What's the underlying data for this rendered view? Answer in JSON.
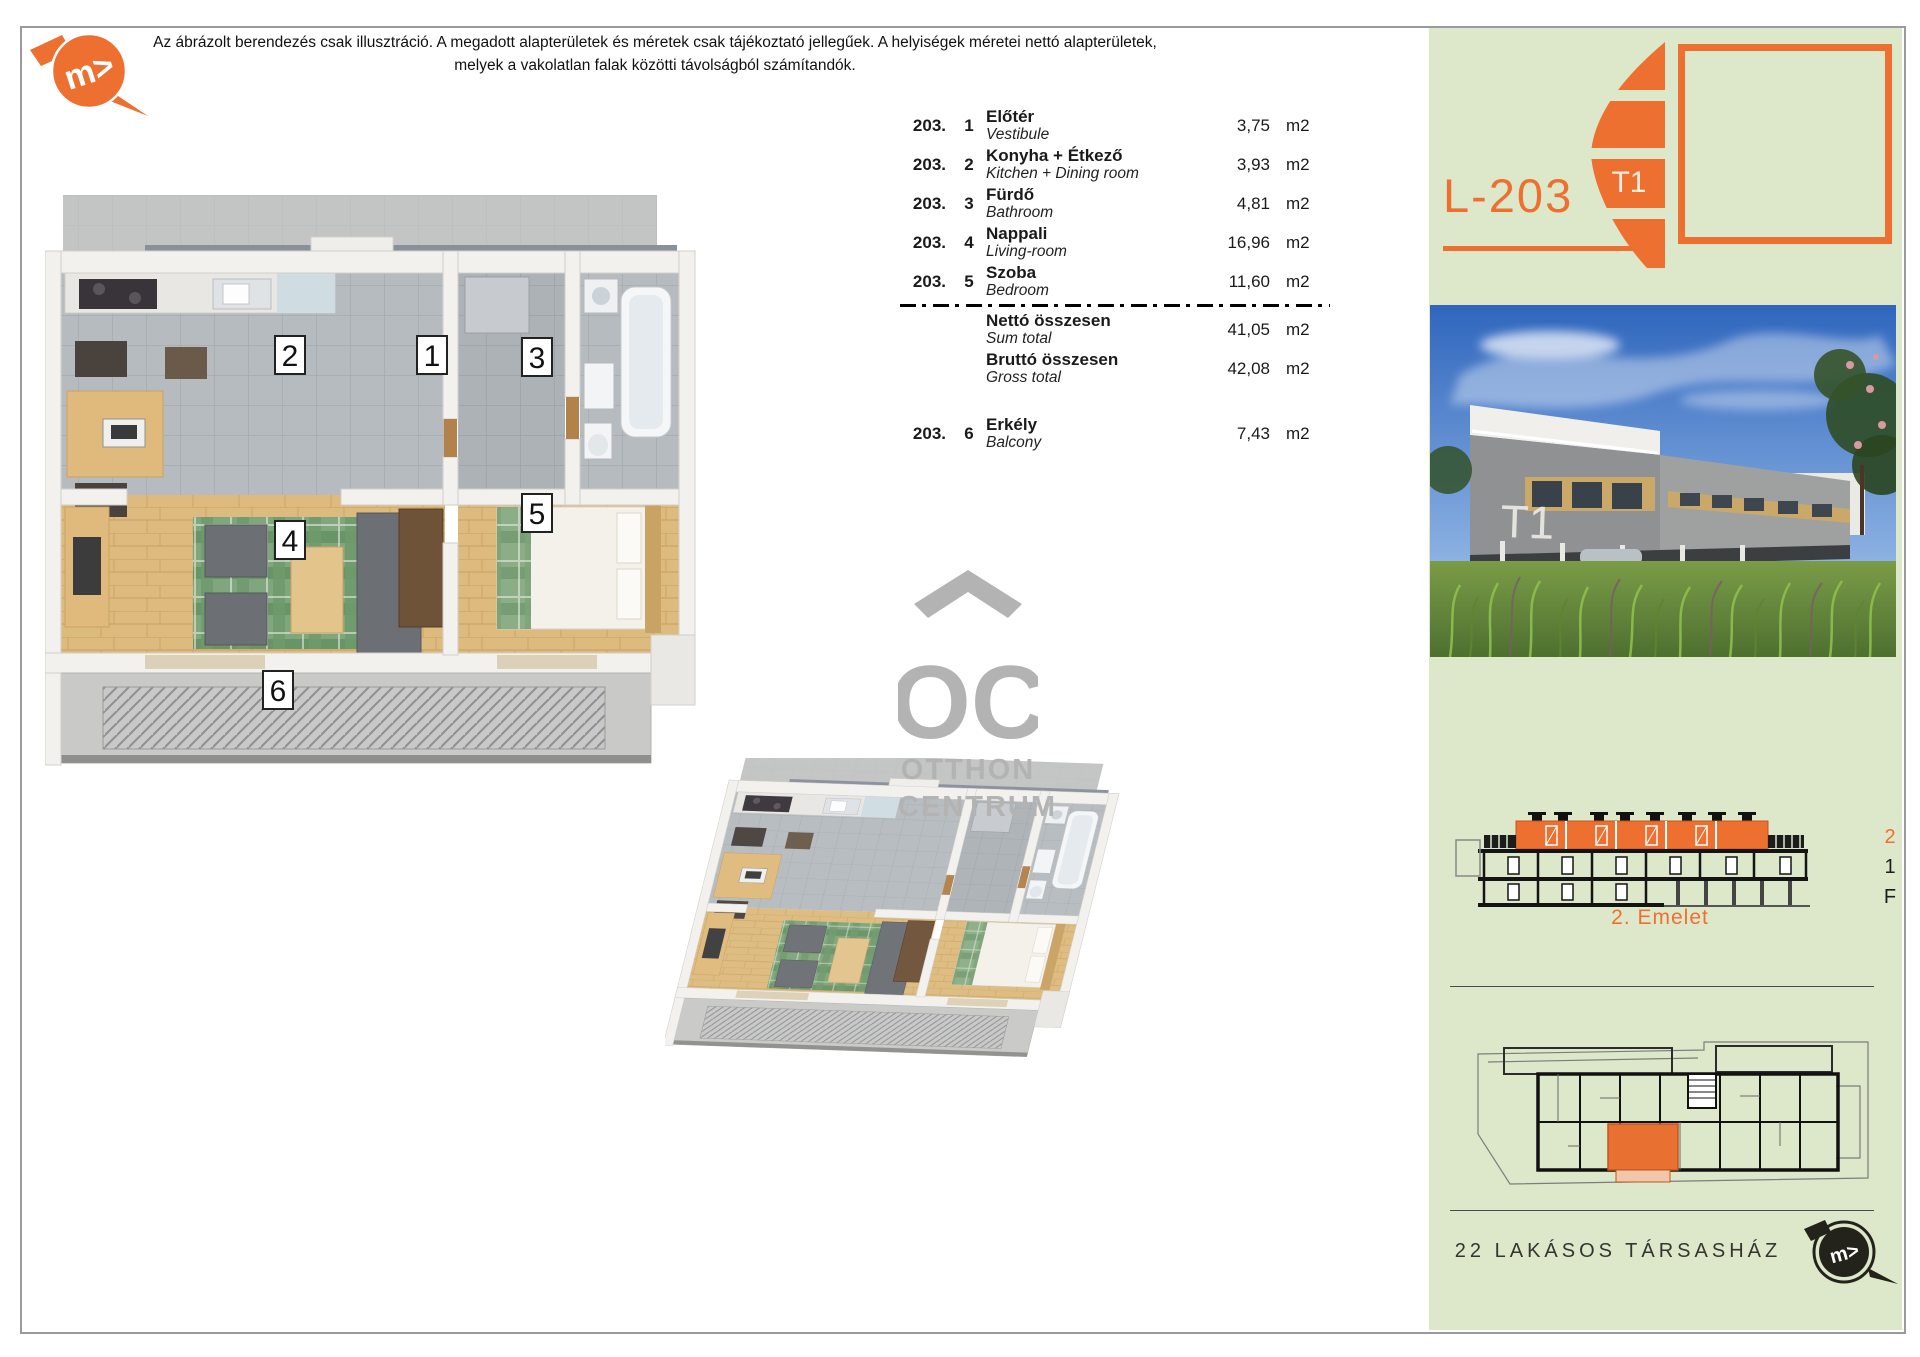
{
  "disclaimer": {
    "line1": "Az ábrázolt berendezés csak illusztráció. A megadott alapterületek és méretek csak tájékoztató jellegűek. A helyiségek méretei nettó alapterületek,",
    "line2": "melyek a vakolatlan falak közötti távolságból számítandók."
  },
  "plan": {
    "labels": [
      "1",
      "2",
      "3",
      "4",
      "5",
      "6"
    ]
  },
  "table": {
    "rows": [
      {
        "num": "203.",
        "idx": "1",
        "name_hu": "Előtér",
        "name_en": "Vestibule",
        "area": "3,75",
        "unit": "m2"
      },
      {
        "num": "203.",
        "idx": "2",
        "name_hu": "Konyha + Étkező",
        "name_en": "Kitchen + Dining room",
        "area": "3,93",
        "unit": "m2"
      },
      {
        "num": "203.",
        "idx": "3",
        "name_hu": "Fürdő",
        "name_en": "Bathroom",
        "area": "4,81",
        "unit": "m2"
      },
      {
        "num": "203.",
        "idx": "4",
        "name_hu": "Nappali",
        "name_en": "Living-room",
        "area": "16,96",
        "unit": "m2"
      },
      {
        "num": "203.",
        "idx": "5",
        "name_hu": "Szoba",
        "name_en": "Bedroom",
        "area": "11,60",
        "unit": "m2"
      }
    ],
    "totals": [
      {
        "name_hu": "Nettó összesen",
        "name_en": "Sum total",
        "area": "41,05",
        "unit": "m2"
      },
      {
        "name_hu": "Bruttó összesen",
        "name_en": "Gross total",
        "area": "42,08",
        "unit": "m2"
      }
    ],
    "balcony_row": {
      "num": "203.",
      "idx": "6",
      "name_hu": "Erkély",
      "name_en": "Balcony",
      "area": "7,43",
      "unit": "m2"
    }
  },
  "oc_logo": {
    "letters": "OC",
    "word1": "OTTHON",
    "word2": "CENTRUM"
  },
  "sidebar": {
    "unit_code": "L-203",
    "badge": "T1",
    "photo_label": "T1",
    "section_floors": [
      "2",
      "1",
      "F"
    ],
    "section_caption": "2. Emelet",
    "footer_text": "22 LAKÁSOS TÁRSASHÁZ"
  },
  "colors": {
    "accent": "#ee7030",
    "sidebar_bg": "#dde8ca",
    "logo_gray": "#b3b3b3"
  }
}
